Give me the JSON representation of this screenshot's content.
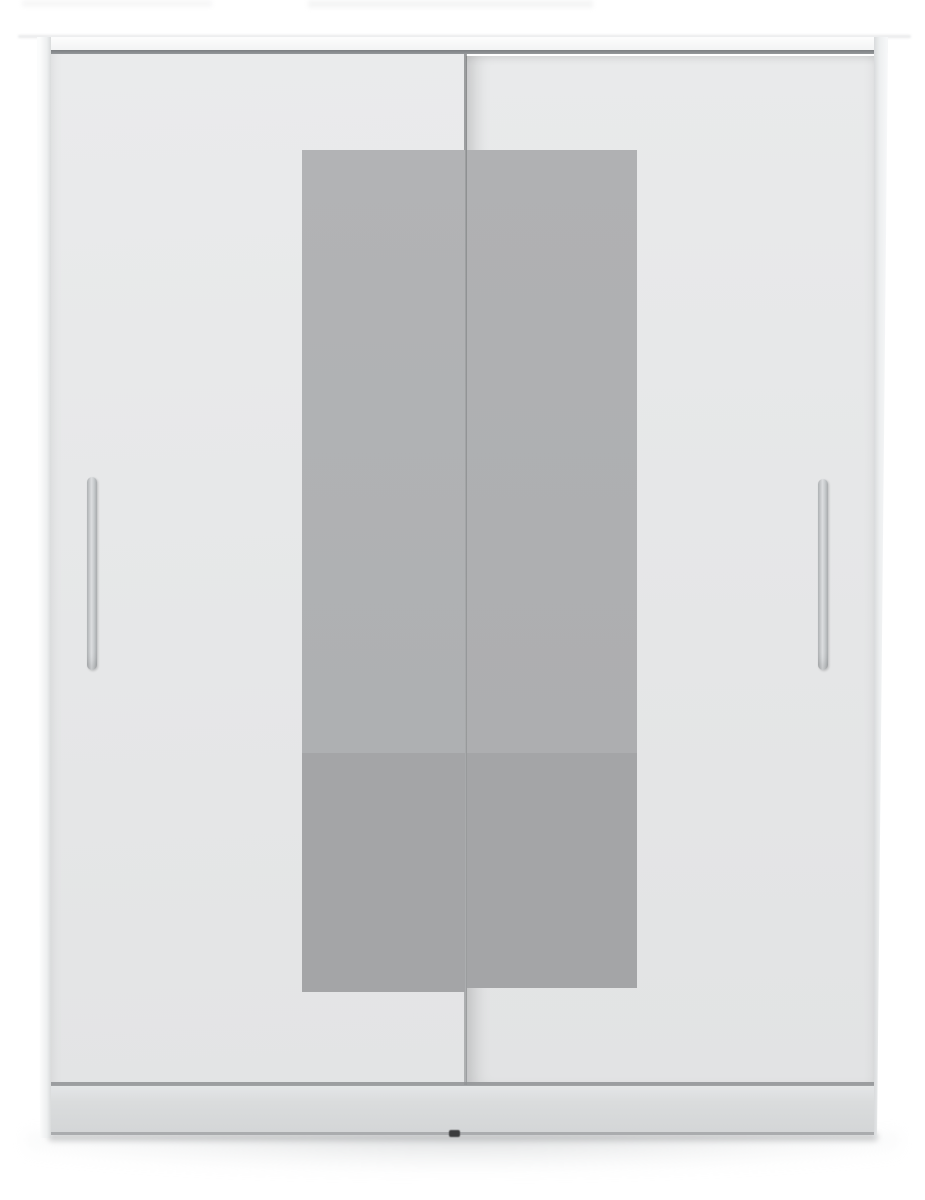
{
  "image": {
    "description": "Front-view product render of a white wardrobe with two sliding doors, a tall vertical bar handle on each door and two tall gray mirror strips meeting at the centre, standing on a recessed plinth against a plain white background with a soft floor shadow",
    "object": "sliding-door mirrored wardrobe",
    "view": "straight-on front view"
  },
  "parts": {
    "cabinet": "wardrobe cabinet",
    "top_strip": "top panel edge",
    "track": "sliding-door top track",
    "left_pillar": "left side frame",
    "right_pillar": "right side frame",
    "left_door": "left sliding door",
    "right_door": "right sliding door",
    "door_seam": "door overlap seam",
    "left_mirror": "left mirror panel",
    "right_mirror": "right mirror panel",
    "mirror_upper": "mirror upper section",
    "mirror_lower": "mirror lower section (floor reflection)",
    "left_handle": "left door bar handle",
    "right_handle": "right door bar handle",
    "plinth": "base plinth",
    "foot": "leveling foot",
    "floor_shadow": "floor shadow",
    "top_artifacts": "faint image artifacts at top edge"
  },
  "colors": {
    "bg": "#ffffff",
    "top-strip": "#f0f1f2",
    "frame-light": "#fbfcfc",
    "frame-mid": "#edeff0",
    "frame-edge": "#d9dbdc",
    "track": "#94979a",
    "door-left-top": "#eaebec",
    "door-left-bottom": "#e3e4e5",
    "door-right-top": "#e9eaeb",
    "door-right-bottom": "#e2e3e4",
    "seam": "#8f9294",
    "mirror-upper": "#b0b1b3",
    "mirror-lower": "#a4a5a7",
    "handle-light": "#dcdee0",
    "handle-dark": "#a8abad",
    "plinth-light": "#e4e6e7",
    "plinth-dark": "#d4d6d7",
    "plinth-edge": "#aaacae",
    "foot": "#3b3c3d",
    "shadow": "#e4e6e7"
  }
}
